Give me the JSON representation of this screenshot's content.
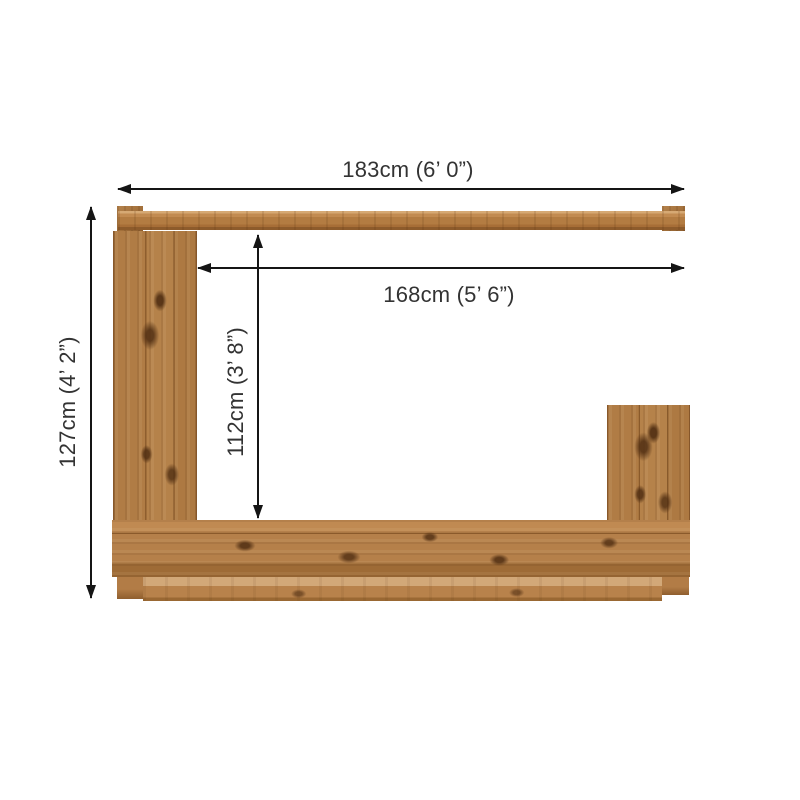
{
  "diagram": {
    "type": "product-dimension-diagram",
    "subject": "wooden bar frame, plan view",
    "labels": {
      "total_width": "183cm (6’ 0”)",
      "inner_width": "168cm (5’ 6”)",
      "total_depth": "127cm (4’ 2”)",
      "inner_depth": "112cm (3’ 8”)"
    },
    "parts": [
      "top-rail",
      "left-post",
      "right-post",
      "bottom-counter",
      "bottom-base"
    ],
    "colors": {
      "background": "#ffffff",
      "wood_main": "#b07c45",
      "wood_dark": "#8a5a2b",
      "wood_light": "#d2a878",
      "knot": "#502e12",
      "dimension_line": "#151515",
      "text": "#333333"
    }
  }
}
